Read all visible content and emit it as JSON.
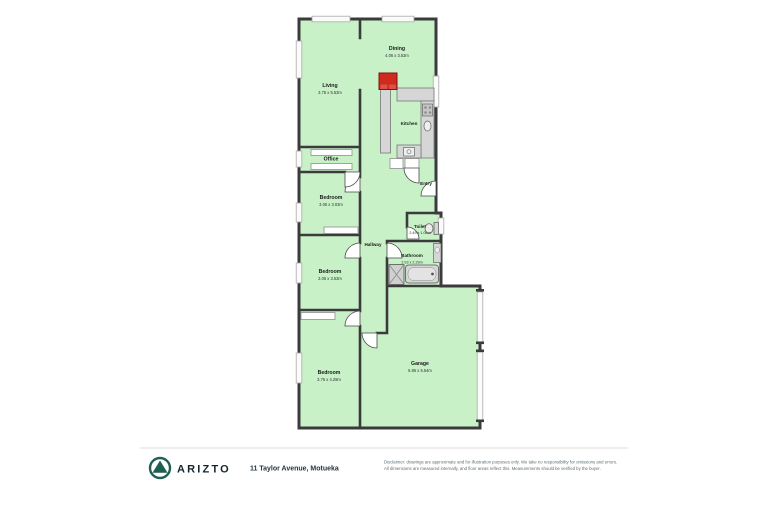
{
  "colors": {
    "room_fill": "#c8f1c8",
    "wall": "#3b3b3b",
    "fixture_fill": "#d6d6d6",
    "fixture_border": "#666666",
    "fireplace_red": "#cf2a1f",
    "brand_teal": "#1d5f53",
    "text_dark": "#14242e",
    "separator": "#dedede"
  },
  "floorplan": {
    "rooms": [
      {
        "name": "Dining",
        "dims": "4.06 x 3.53m"
      },
      {
        "name": "Living",
        "dims": "3.75 x 5.53m"
      },
      {
        "name": "Kitchen"
      },
      {
        "name": "Office"
      },
      {
        "name": "Entry"
      },
      {
        "name": "Bedroom",
        "dims": "3.06 x 3.03m"
      },
      {
        "name": "Hallway"
      },
      {
        "name": "Toilet",
        "dims": "2.49 x 1.06m"
      },
      {
        "name": "Bathroom",
        "dims": "2.93 x 2.29m"
      },
      {
        "name": "Bedroom",
        "dims": "3.05 x 3.53m"
      },
      {
        "name": "Bedroom",
        "dims": "3.75 x 4.29m"
      },
      {
        "name": "Garage",
        "dims": "5.86 x 5.54m"
      }
    ],
    "icons": {
      "fireplace": "red block",
      "stove-icon": "4 burner circles",
      "sink-icon": "oval basin",
      "dishwasher-icon": "square with circle",
      "toilet-icon": "bowl with cistern",
      "shower-icon": "square with X",
      "bathtub-icon": "rounded tub",
      "vanity-icon": "counter with basin",
      "arizto-logo-icon": "mountain in circle"
    }
  },
  "footer": {
    "brand": "ARIZTO",
    "address": "11 Taylor Avenue, Motueka",
    "disclaimer_line1": "Disclaimer: drawings are approximate and for illustration purposes only. We take no responsibility for omissions and errors.",
    "disclaimer_line2": "All dimensions are measured internally, and floor areas reflect this. Measurements should be verified by the buyer."
  }
}
